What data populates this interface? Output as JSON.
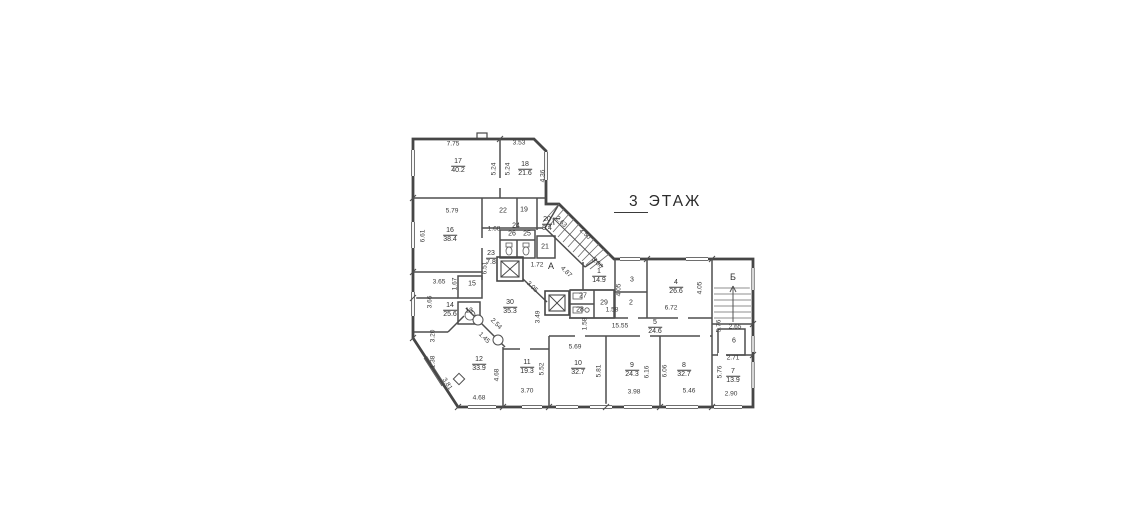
{
  "title": {
    "number": "3",
    "word": "ЭТАЖ"
  },
  "colors": {
    "ink": "#3f3f3f",
    "paper": "#ffffff"
  },
  "floorplan": {
    "rooms": [
      {
        "number": "17",
        "area": "40.2",
        "x": 458,
        "y": 166
      },
      {
        "number": "18",
        "area": "21.6",
        "x": 525,
        "y": 169
      },
      {
        "number": "16",
        "area": "38.4",
        "x": 450,
        "y": 235
      },
      {
        "number": "20",
        "area": "8.4",
        "x": 547,
        "y": 224
      },
      {
        "number": "23",
        "area": "7.8",
        "x": 491,
        "y": 258
      },
      {
        "number": "1",
        "area": "14.9",
        "x": 599,
        "y": 276
      },
      {
        "number": "4",
        "area": "26.6",
        "x": 676,
        "y": 287
      },
      {
        "number": "5",
        "area": "24.6",
        "x": 655,
        "y": 327
      },
      {
        "number": "30",
        "area": "35.3",
        "x": 510,
        "y": 307
      },
      {
        "number": "14",
        "area": "25.6",
        "x": 450,
        "y": 310
      },
      {
        "number": "12",
        "area": "33.9",
        "x": 479,
        "y": 364
      },
      {
        "number": "11",
        "area": "19.3",
        "x": 527,
        "y": 367
      },
      {
        "number": "10",
        "area": "32.7",
        "x": 578,
        "y": 368
      },
      {
        "number": "9",
        "area": "24.3",
        "x": 632,
        "y": 370
      },
      {
        "number": "8",
        "area": "32.7",
        "x": 684,
        "y": 370
      },
      {
        "number": "7",
        "area": "13.9",
        "x": 733,
        "y": 376
      }
    ],
    "cells": [
      {
        "label": "22",
        "x": 503,
        "y": 211
      },
      {
        "label": "19",
        "x": 524,
        "y": 210
      },
      {
        "label": "24",
        "x": 516,
        "y": 226
      },
      {
        "label": "26",
        "x": 512,
        "y": 234
      },
      {
        "label": "25",
        "x": 527,
        "y": 234
      },
      {
        "label": "21",
        "x": 545,
        "y": 247
      },
      {
        "label": "15",
        "x": 472,
        "y": 284
      },
      {
        "label": "13",
        "x": 469,
        "y": 311
      },
      {
        "label": "3",
        "x": 632,
        "y": 280
      },
      {
        "label": "2",
        "x": 631,
        "y": 303
      },
      {
        "label": "27",
        "x": 583,
        "y": 296
      },
      {
        "label": "28",
        "x": 580,
        "y": 310
      },
      {
        "label": "29",
        "x": 604,
        "y": 303
      },
      {
        "label": "6",
        "x": 734,
        "y": 341
      }
    ],
    "stairs": [
      {
        "label": "А",
        "x": 551,
        "y": 266
      },
      {
        "label": "Б",
        "x": 733,
        "y": 277
      }
    ],
    "dims": [
      {
        "t": "7.75",
        "x": 453,
        "y": 144,
        "r": 0
      },
      {
        "t": "3.53",
        "x": 519,
        "y": 143,
        "r": 0
      },
      {
        "t": "5.24",
        "x": 494,
        "y": 169,
        "r": -90
      },
      {
        "t": "5.24",
        "x": 508,
        "y": 169,
        "r": -90
      },
      {
        "t": "4.36",
        "x": 543,
        "y": 176,
        "r": -90
      },
      {
        "t": "5.79",
        "x": 452,
        "y": 211,
        "r": 0
      },
      {
        "t": "6.61",
        "x": 423,
        "y": 236,
        "r": -90
      },
      {
        "t": "1.68",
        "x": 494,
        "y": 229,
        "r": 0
      },
      {
        "t": "6.51",
        "x": 485,
        "y": 268,
        "r": -90
      },
      {
        "t": "3.65",
        "x": 439,
        "y": 282,
        "r": 0
      },
      {
        "t": "1.67",
        "x": 455,
        "y": 284,
        "r": -90
      },
      {
        "t": "3.66",
        "x": 430,
        "y": 302,
        "r": -90
      },
      {
        "t": "3.20",
        "x": 433,
        "y": 336,
        "r": -90
      },
      {
        "t": "1.38",
        "x": 433,
        "y": 362,
        "r": -90
      },
      {
        "t": "3.81",
        "x": 447,
        "y": 384,
        "r": 57
      },
      {
        "t": "4.68",
        "x": 479,
        "y": 398,
        "r": 0
      },
      {
        "t": "4.68",
        "x": 497,
        "y": 375,
        "r": -90
      },
      {
        "t": "3.70",
        "x": 527,
        "y": 391,
        "r": 0
      },
      {
        "t": "5.52",
        "x": 542,
        "y": 369,
        "r": -90
      },
      {
        "t": "2.54",
        "x": 496,
        "y": 324,
        "r": 45
      },
      {
        "t": "1.45",
        "x": 484,
        "y": 338,
        "r": 45
      },
      {
        "t": "3.49",
        "x": 538,
        "y": 317,
        "r": -90
      },
      {
        "t": "3.05",
        "x": 532,
        "y": 287,
        "r": 45
      },
      {
        "t": "1.72",
        "x": 537,
        "y": 265,
        "r": 0
      },
      {
        "t": "2.63",
        "x": 561,
        "y": 222,
        "r": 45
      },
      {
        "t": "2.50",
        "x": 585,
        "y": 234,
        "r": 45
      },
      {
        "t": "4.87",
        "x": 566,
        "y": 272,
        "r": 45
      },
      {
        "t": "3.86",
        "x": 597,
        "y": 263,
        "r": 45
      },
      {
        "t": "5.69",
        "x": 575,
        "y": 347,
        "r": 0
      },
      {
        "t": "5.81",
        "x": 599,
        "y": 371,
        "r": -90
      },
      {
        "t": "6.16",
        "x": 647,
        "y": 372,
        "r": -90
      },
      {
        "t": "6.06",
        "x": 665,
        "y": 371,
        "r": -90
      },
      {
        "t": "3.98",
        "x": 634,
        "y": 392,
        "r": 0
      },
      {
        "t": "5.46",
        "x": 689,
        "y": 391,
        "r": 0
      },
      {
        "t": "2.90",
        "x": 731,
        "y": 394,
        "r": 0
      },
      {
        "t": "5.76",
        "x": 720,
        "y": 372,
        "r": -90
      },
      {
        "t": "2.71",
        "x": 733,
        "y": 358,
        "r": 0
      },
      {
        "t": "2.65",
        "x": 735,
        "y": 327,
        "r": 0
      },
      {
        "t": "5.76",
        "x": 719,
        "y": 326,
        "r": -90
      },
      {
        "t": "15.55",
        "x": 620,
        "y": 326,
        "r": 0
      },
      {
        "t": "1.58",
        "x": 612,
        "y": 310,
        "r": 0
      },
      {
        "t": "1.58",
        "x": 585,
        "y": 324,
        "r": -90
      },
      {
        "t": "6.72",
        "x": 671,
        "y": 308,
        "r": 0
      },
      {
        "t": "4.05",
        "x": 619,
        "y": 290,
        "r": -90
      },
      {
        "t": "4.05",
        "x": 700,
        "y": 288,
        "r": -90
      }
    ]
  }
}
